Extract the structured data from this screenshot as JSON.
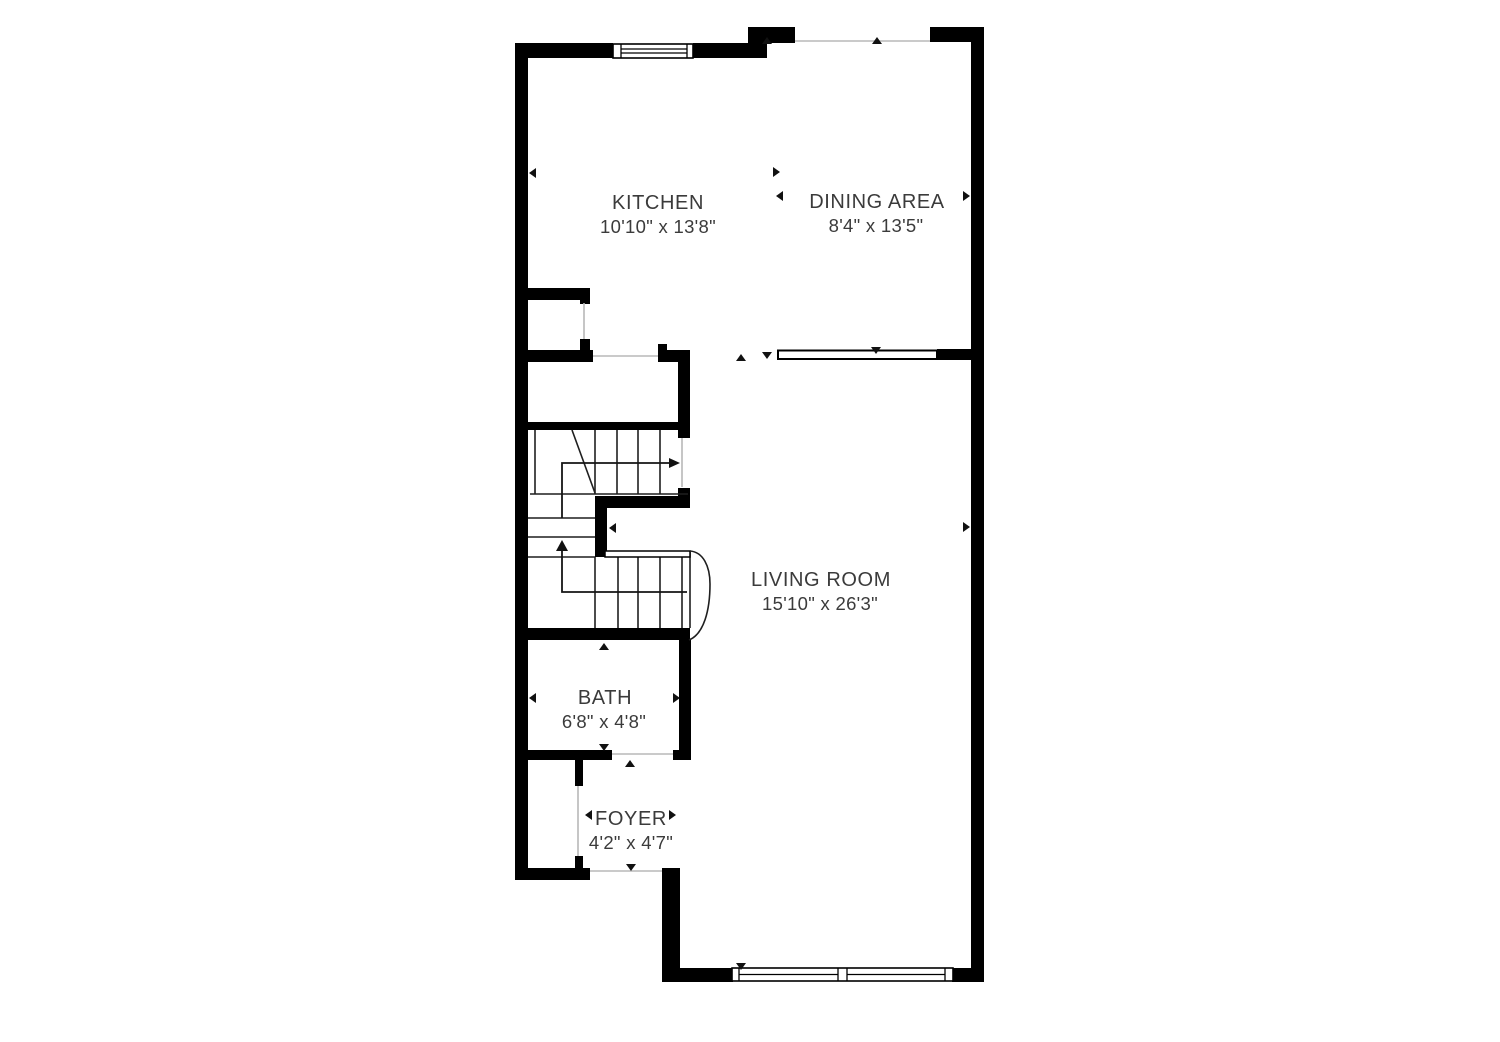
{
  "colors": {
    "background": "#ffffff",
    "wall_color": "#000000",
    "text_color": "#3b3b3b",
    "stair_line_color": "#1f1f1f",
    "opening_line_color": "#b8b8b8"
  },
  "rooms": [
    {
      "name": "KITCHEN",
      "dimensions": "10'10\" x 13'8\""
    },
    {
      "name": "DINING AREA",
      "dimensions": "8'4\" x 13'5\""
    },
    {
      "name": "LIVING ROOM",
      "dimensions": "15'10\" x 26'3\""
    },
    {
      "name": "BATH",
      "dimensions": "6'8\" x 4'8\""
    },
    {
      "name": "FOYER",
      "dimensions": "4'2\" x 4'7\""
    }
  ]
}
